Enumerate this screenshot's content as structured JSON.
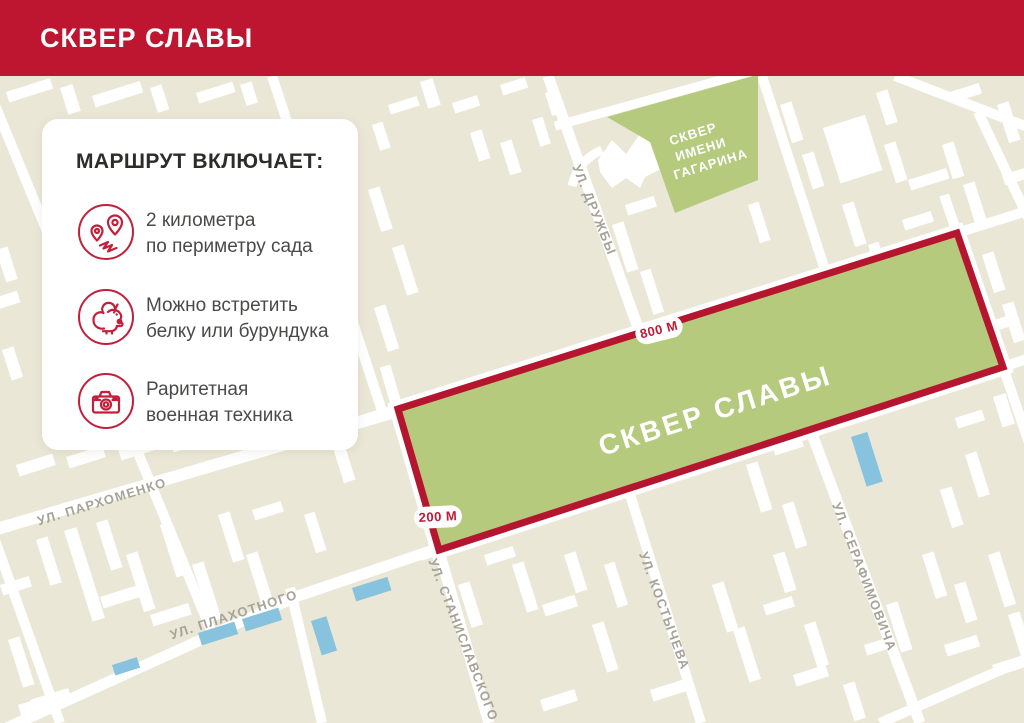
{
  "header": {
    "title": "СКВЕР СЛАВЫ"
  },
  "card": {
    "title": "МАРШРУТ ВКЛЮЧАЕТ:",
    "items": [
      {
        "icon": "route-pins-icon",
        "line1": "2 километра",
        "line2": "по периметру сада"
      },
      {
        "icon": "squirrel-icon",
        "line1": "Можно встретить",
        "line2": "белку или бурундука"
      },
      {
        "icon": "camera-icon",
        "line1": "Раритетная",
        "line2": "военная техника"
      }
    ]
  },
  "map": {
    "park": {
      "name": "СКВЕР СЛАВЫ",
      "top_length_label": "800 М",
      "side_length_label": "200 М",
      "fill_color": "#B5CA7D",
      "border_color": "#B5152E"
    },
    "gagarin_square": {
      "line1": "СКВЕР",
      "line2": "ИМЕНИ",
      "line3": "ГАГАРИНА"
    },
    "streets": [
      {
        "label": "УЛ. ДРУЖБЫ"
      },
      {
        "label": "УЛ. ПАРХОМЕНКО"
      },
      {
        "label": "УЛ. ПЛАХОТНОГО"
      },
      {
        "label": "УЛ. СТАНИСЛАВСКОГО"
      },
      {
        "label": "УЛ. КОСТЫЧЕВА"
      },
      {
        "label": "УЛ. СЕРАФИМОВИЧА"
      }
    ],
    "colors": {
      "header_red": "#BE1530",
      "background": "#EBE7D6",
      "building": "#FFFFFF",
      "water": "#87C2DE",
      "street_label": "#A6A399",
      "icon_red": "#C2203A"
    }
  }
}
